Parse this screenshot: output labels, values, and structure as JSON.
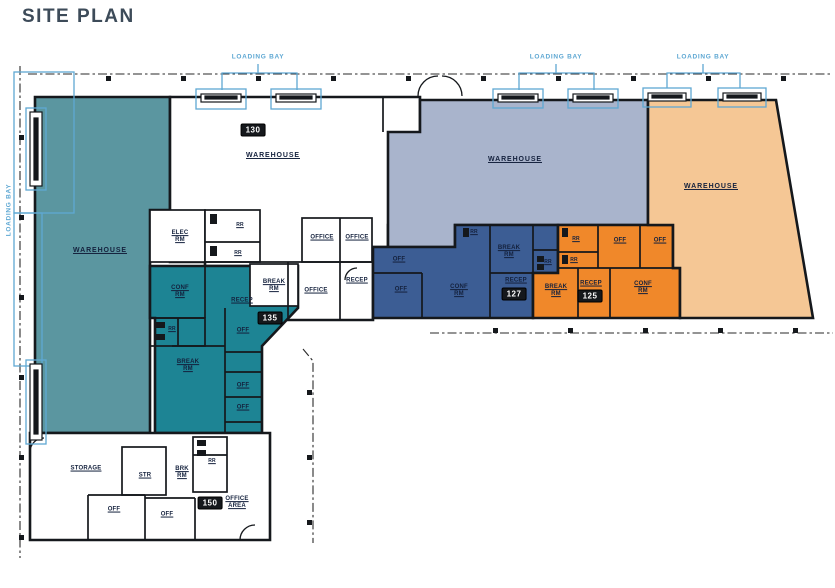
{
  "title": "SITE PLAN",
  "colors": {
    "title_text": "#3d4b59",
    "label_text": "#14213d",
    "loading_bay_accent": "#5fa8d3",
    "wall": "#15181c",
    "warehouse_teal": "#5b96a0",
    "suite_135_teal": "#1d8494",
    "warehouse_blue_gray": "#a9b4cc",
    "suite_127_blue": "#3c5d94",
    "suite_125_orange": "#f0882a",
    "warehouse_tan": "#f5c795"
  },
  "labels": {
    "loading_bay": "LOADING BAY",
    "warehouse": "WAREHOUSE",
    "office": "OFFICE",
    "off": "OFF",
    "recep": "RECEP",
    "conf_rm": "CONF\nRM",
    "break_rm": "BREAK\nRM",
    "brk_rm": "BRK\nRM",
    "elec_rm": "ELEC\nRM",
    "rr": "RR",
    "storage": "STORAGE",
    "str": "STR",
    "office_area": "OFFICE\nAREA"
  },
  "suites": {
    "s130": {
      "number": "130"
    },
    "s135": {
      "number": "135"
    },
    "s127": {
      "number": "127"
    },
    "s125": {
      "number": "125"
    },
    "s150": {
      "number": "150"
    }
  }
}
